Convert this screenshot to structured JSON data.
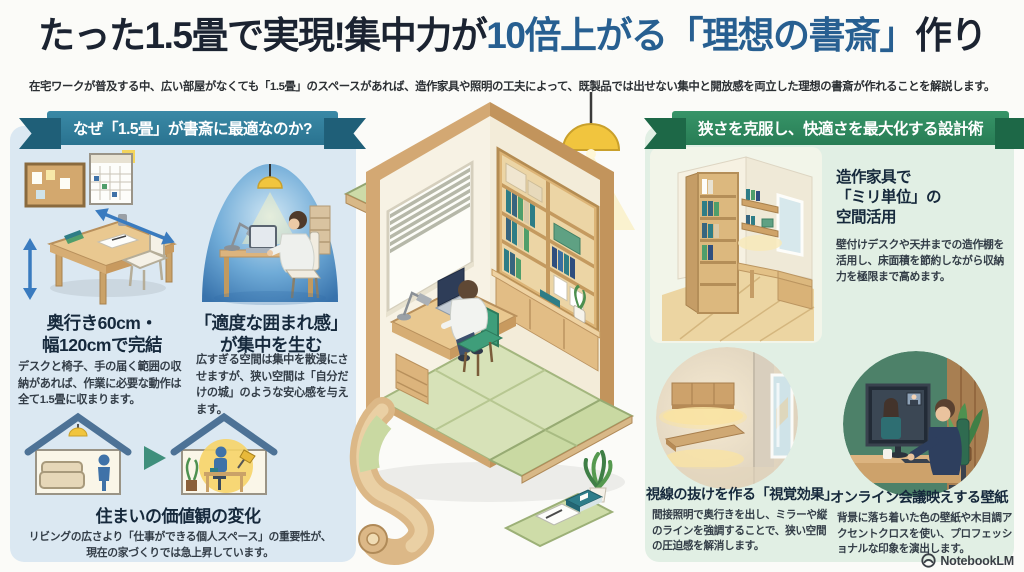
{
  "header": {
    "title": {
      "part1": "たった1.5畳で実現!集中力が",
      "part2": "10倍上がる",
      "part3": "「理想の書斎」",
      "part4": "作り"
    },
    "subtitle": "在宅ワークが普及する中、広い部屋がなくても「1.5畳」のスペースがあれば、造作家具や照明の工夫によって、既製品では出せない集中と開放感を両立した理想の書斎が作れることを解説します。"
  },
  "left_section": {
    "banner": "なぜ「1.5畳」が書斎に最適なのか?",
    "blocks": [
      {
        "heading": "奥行き60cm・\n幅120cmで完結",
        "body": "デスクと椅子、手の届く範囲の収納があれば、作業に必要な動作は全て1.5畳に収まります。"
      },
      {
        "heading": "「適度な囲まれ感」\nが集中を生む",
        "body": "広すぎる空間は集中を散漫にさせますが、狭い空間は「自分だけの城」のような安心感を与えます。"
      },
      {
        "heading": "住まいの価値観の変化",
        "body": "リビングの広さより「仕事ができる個人スペース」の重要性が、現在の家づくりでは急上昇しています。"
      }
    ]
  },
  "right_section": {
    "banner": "狭さを克服し、快適さを最大化する設計術",
    "blocks": [
      {
        "heading": "造作家具で\n「ミリ単位」の\n空間活用",
        "body": "壁付けデスクや天井までの造作棚を活用し、床面積を節約しながら収納力を極限まで高めます。"
      },
      {
        "heading": "視線の抜けを作る「視覚効果」",
        "body": "間接照明で奥行きを出し、ミラーや縦のラインを強調することで、狭い空間の圧迫感を解消します。"
      },
      {
        "heading": "オンライン会議映えする壁紙",
        "body": "背景に落ち着いた色の壁紙や木目調アクセントクロスを使い、プロフェッショナルな印象を演出します。"
      }
    ]
  },
  "footer": {
    "brand": "NotebookLM"
  },
  "colors": {
    "title_accent": "#275f91",
    "left_banner": "#2a7390",
    "right_banner": "#287d55",
    "left_panel_bg": "#dbe8f2",
    "right_panel_bg": "#e1efe4",
    "tatami_green": "#cddba8",
    "wood": "#dcb476"
  }
}
